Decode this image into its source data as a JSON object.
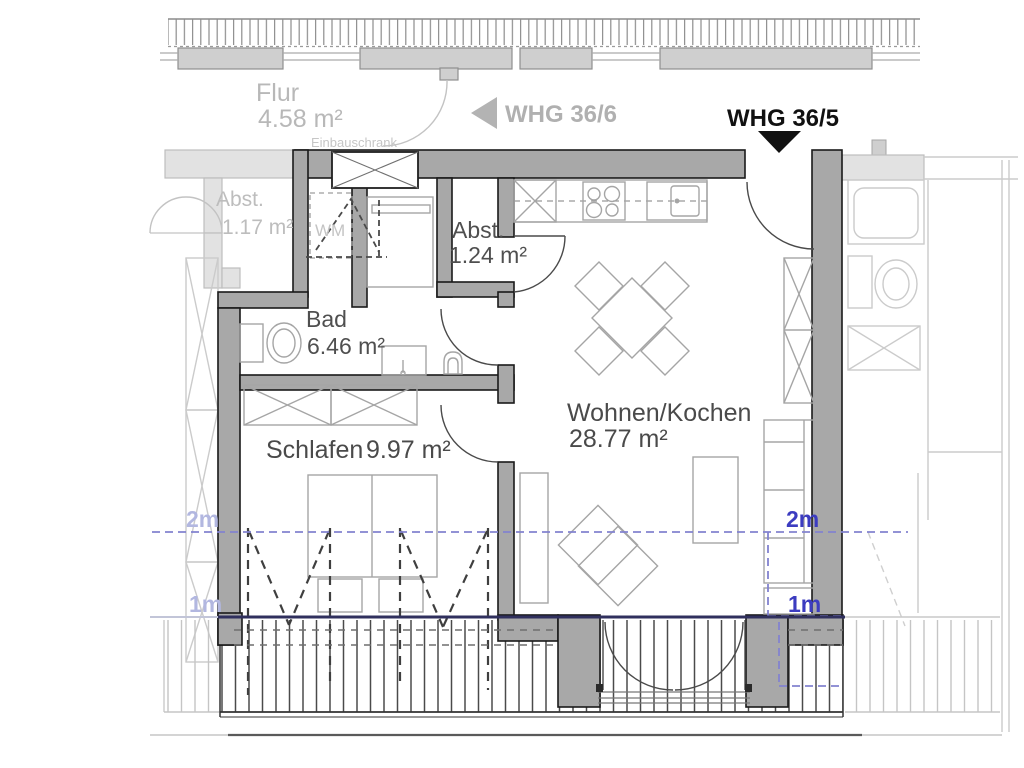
{
  "plan": {
    "current_unit": "WHG 36/5",
    "adjacent_unit": "WHG 36/6"
  },
  "rooms": {
    "flur": {
      "name": "Flur",
      "area": "4.58 m²"
    },
    "abst_outside": {
      "name": "Abst.",
      "area": "1.17 m²"
    },
    "abst_inside": {
      "name": "Abst.",
      "area": "1.24 m²"
    },
    "bad": {
      "name": "Bad",
      "area": "6.46 m²"
    },
    "schlafen": {
      "name": "Schlafen",
      "area": "9.97 m²"
    },
    "wohnen_kochen": {
      "name": "Wohnen/Kochen",
      "area": "28.77 m²"
    }
  },
  "annotations": {
    "einbauschrank": "Einbauschrank",
    "wm": "WM"
  },
  "height_markers": {
    "left_2m": "2m",
    "left_1m": "1m",
    "right_2m": "2m",
    "right_1m": "1m"
  },
  "colors": {
    "wall_fill": "#a8a8a8",
    "wall_outline": "#1a1a1a",
    "outside_wall_fill": "#e2e2e2",
    "unit_label_dark": "#111111",
    "unit_label_grey": "#b0b0b0",
    "room_label": "#4f4f4f",
    "outside_label": "#b8b8b8",
    "marker_blue_right": "#3c3cc0",
    "marker_blue_left": "#b2b7e0",
    "height_line_blue": "#8282cf",
    "one_meter_line_navy": "#30305e"
  }
}
